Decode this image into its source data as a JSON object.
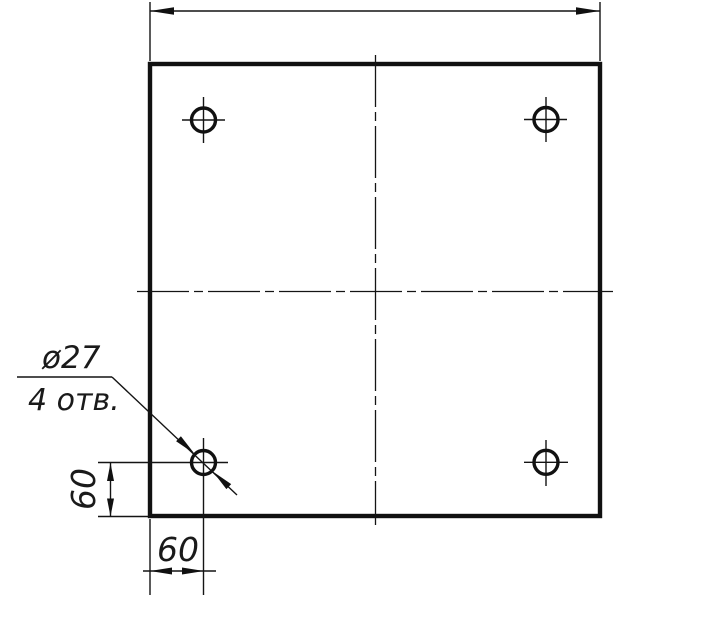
{
  "drawing": {
    "kind": "technical-drawing",
    "labels": {
      "leader_note_line1": "ø27",
      "leader_note_line2": "4 отв.",
      "dim_left_vertical": "60",
      "dim_bottom_horizontal": "60"
    },
    "colors": {
      "ink": "#111111",
      "background": "#ffffff"
    }
  }
}
